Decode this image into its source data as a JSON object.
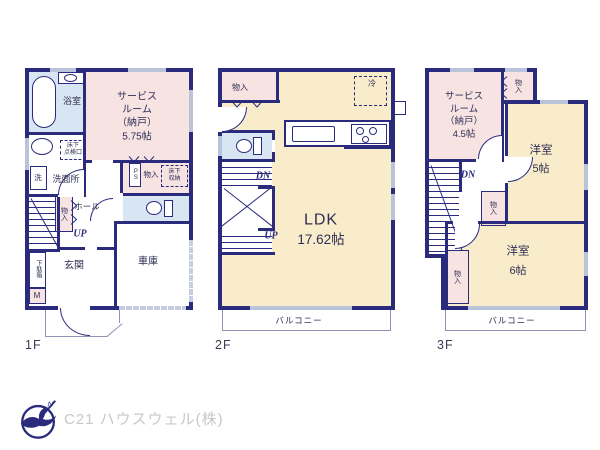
{
  "palette": {
    "wall": "#2b2b7e",
    "pink": "#f8e3e3",
    "cream": "#f9ecca",
    "blue": "#d8e6f3",
    "window": "#b9c3da",
    "shutter": "#c7cde0",
    "thin": "#8e94b5",
    "ink": "#2f2f55",
    "floor_label": "#3b3b52",
    "company": "#c8c8c8",
    "bg": "#ffffff"
  },
  "floors": {
    "f1": {
      "label": "1F",
      "bath": "浴室",
      "washroom": "洗面所",
      "washer": "洗",
      "hatch_l1": "床下",
      "hatch_l2": "点検口",
      "service_l1": "サービス",
      "service_l2": "ルーム",
      "service_l3": "（納戸）",
      "service_l4": "5.75帖",
      "closet": "物入",
      "storage_l1": "床下",
      "storage_l2": "収納",
      "ps": "PS",
      "hall": "ホール",
      "hall_closet": "物入",
      "up": "UP",
      "shoe": "下駄箱",
      "meter": "M",
      "entrance": "玄関",
      "garage": "車庫"
    },
    "f2": {
      "label": "2F",
      "closet": "物入",
      "fridge": "冷",
      "ldk": "LDK",
      "ldk_area": "17.62帖",
      "dn": "DN",
      "up": "UP",
      "balcony": "バルコニー"
    },
    "f3": {
      "label": "3F",
      "service_l1": "サービス",
      "service_l2": "ルーム",
      "service_l3": "（納戸）",
      "service_l4": "4.5帖",
      "closet_top": "物入",
      "room5": "洋室",
      "room5_area": "5帖",
      "dn": "DN",
      "closet_mid": "物入",
      "closet_left": "物入",
      "room6": "洋室",
      "room6_area": "6帖",
      "balcony": "バルコニー"
    }
  },
  "footer": {
    "company": "C21 ハウスウェル(株)",
    "north": "N"
  }
}
